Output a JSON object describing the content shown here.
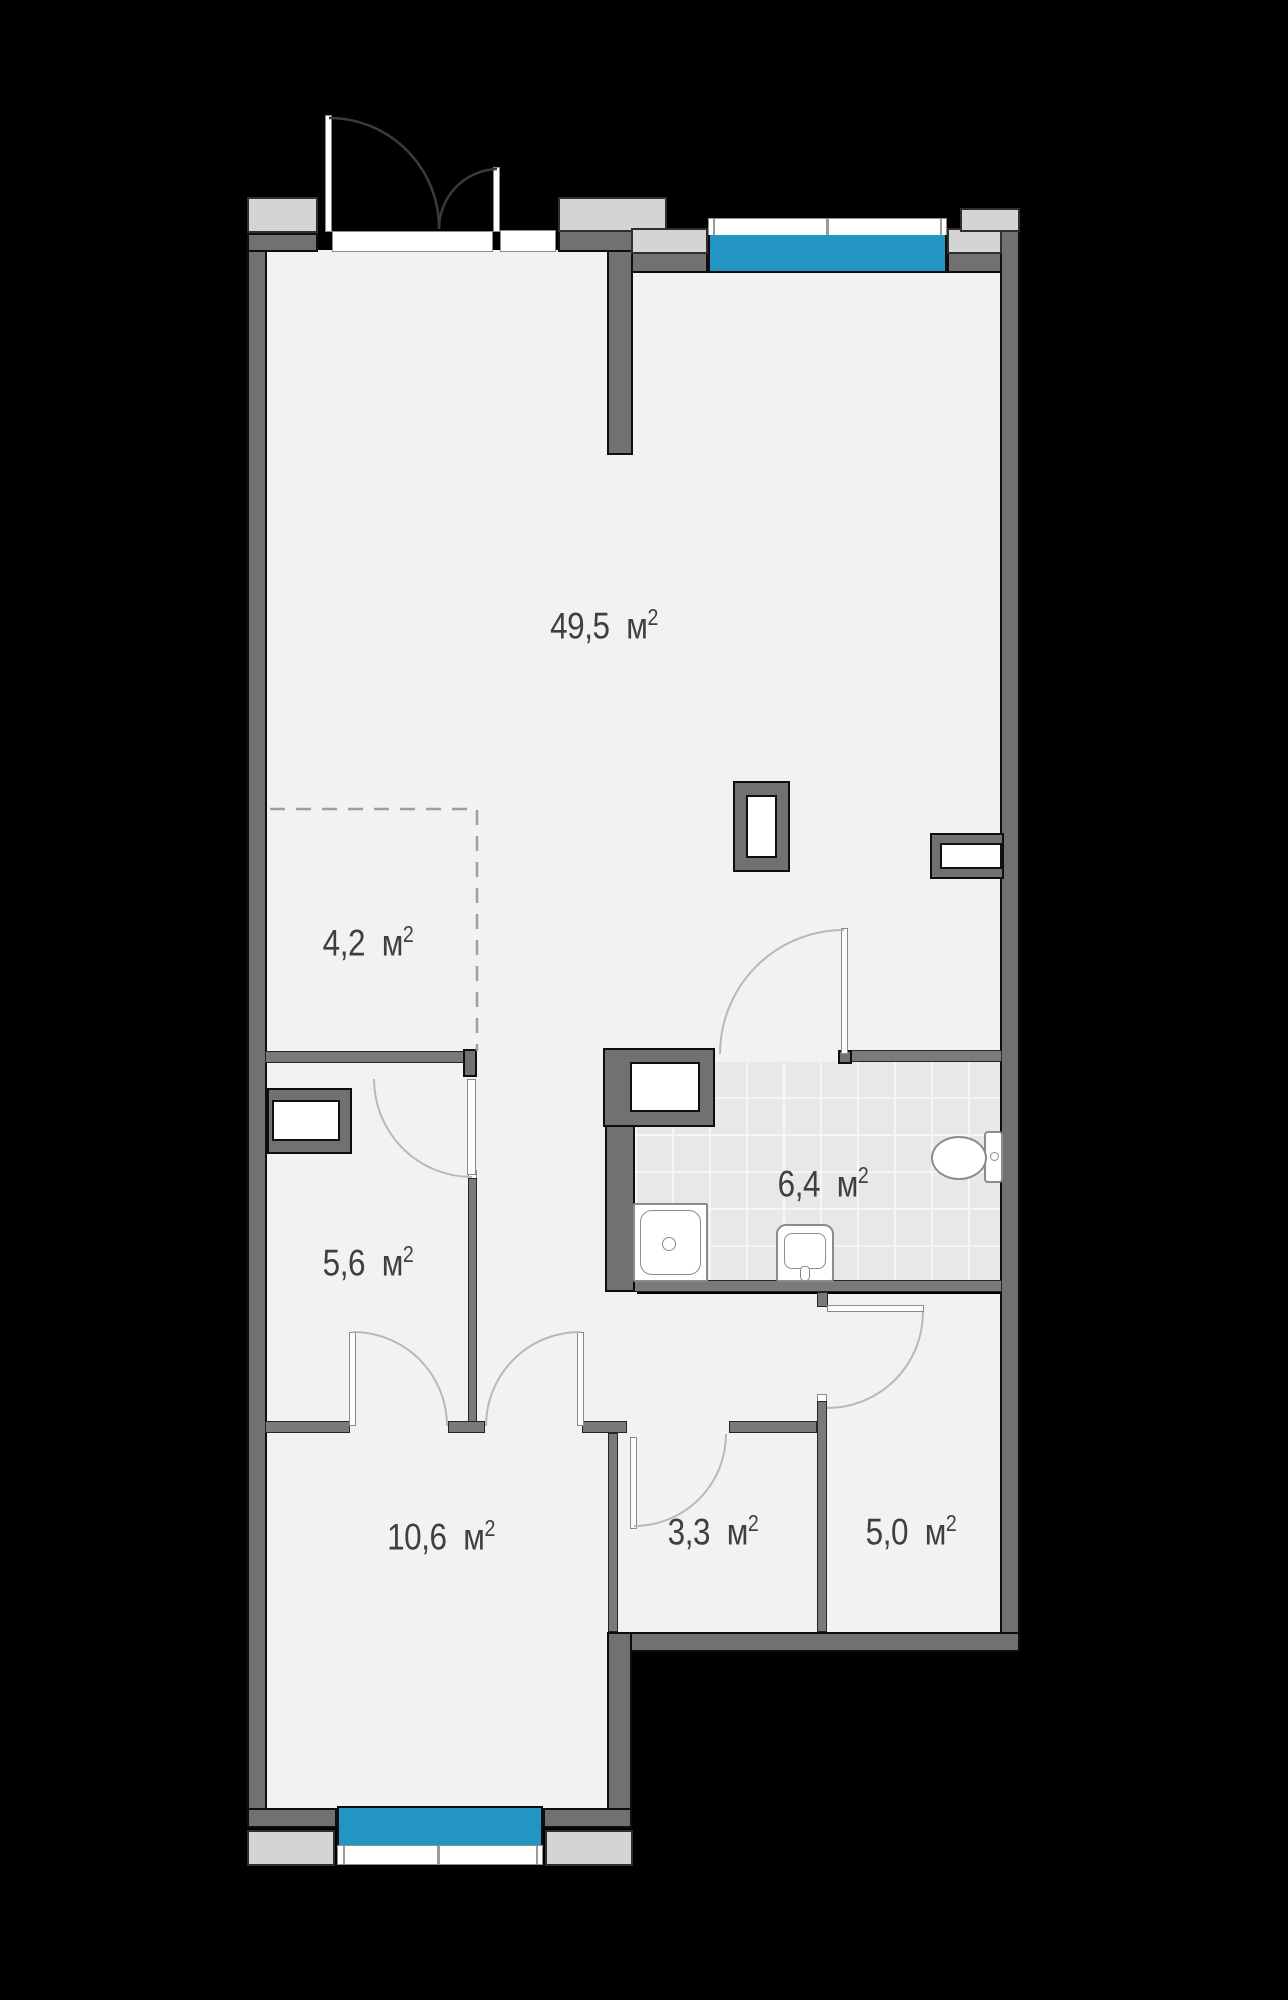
{
  "plan": {
    "title": "apartment-floor-plan",
    "unit": {
      "base": "м",
      "sup": "2"
    },
    "rooms": [
      {
        "id": "living",
        "area": "49,5"
      },
      {
        "id": "zone",
        "area": "4,2"
      },
      {
        "id": "corridor",
        "area": "5,6"
      },
      {
        "id": "bathroom",
        "area": "6,4"
      },
      {
        "id": "bedroom",
        "area": "10,6"
      },
      {
        "id": "storage",
        "area": "3,3"
      },
      {
        "id": "cabinet",
        "area": "5,0"
      }
    ],
    "fixtures": [
      "toilet",
      "sink",
      "shower-tray",
      "vent-shaft",
      "entrance-double-door"
    ],
    "colors": {
      "background": "#000000",
      "floor": "#f2f2f2",
      "wall": "#717171",
      "exterior_pad": "#d4d4d4",
      "window_glass": "#2395c4",
      "label_text": "#3f3f3f"
    }
  }
}
